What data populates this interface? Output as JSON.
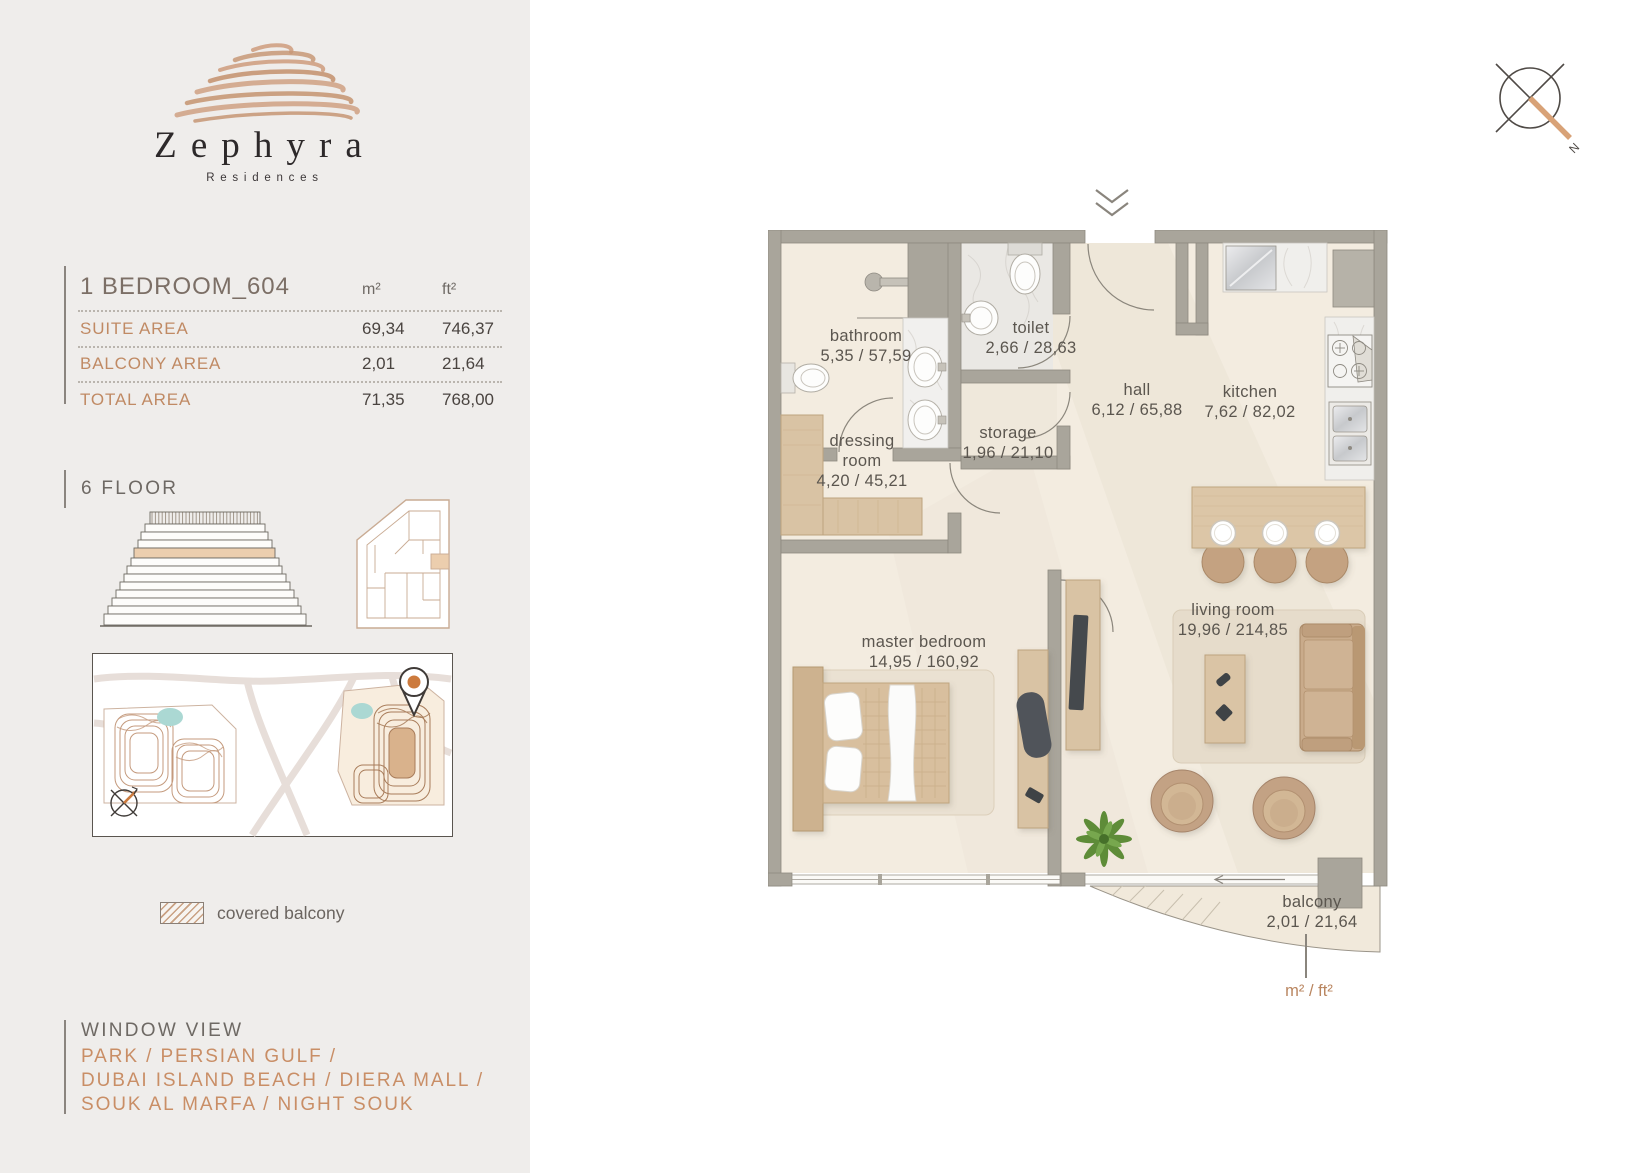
{
  "brand": {
    "name": "Zephyra",
    "tagline": "Residences"
  },
  "unit": {
    "title": "1 BEDROOM_604",
    "col_m2": "m²",
    "col_ft2": "ft²",
    "rows": [
      {
        "label": "SUITE AREA",
        "m2": "69,34",
        "ft2": "746,37"
      },
      {
        "label": "BALCONY AREA",
        "m2": "2,01",
        "ft2": "21,64"
      },
      {
        "label": "TOTAL AREA",
        "m2": "71,35",
        "ft2": "768,00"
      }
    ]
  },
  "floor": {
    "label": "6 FLOOR"
  },
  "legend": {
    "covered_balcony": "covered balcony"
  },
  "window_view": {
    "title": "WINDOW VIEW",
    "lines": [
      "PARK / PERSIAN GULF /",
      "DUBAI ISLAND BEACH / DIERA MALL /",
      "SOUK AL MARFA / NIGHT SOUK"
    ]
  },
  "plan": {
    "rooms": [
      {
        "name": "bathroom",
        "area": "5,35 / 57,59"
      },
      {
        "name": "toilet",
        "area": "2,66 / 28,63"
      },
      {
        "name": "hall",
        "area": "6,12 / 65,88"
      },
      {
        "name": "kitchen",
        "area": "7,62 / 82,02"
      },
      {
        "name": "storage",
        "area": "1,96 / 21,10"
      },
      {
        "name": "dressing room",
        "area": "4,20 / 45,21"
      },
      {
        "name": "master bedroom",
        "area": "14,95 / 160,92"
      },
      {
        "name": "living room",
        "area": "19,96 / 214,85"
      },
      {
        "name": "balcony",
        "area": "2,01 / 21,64"
      }
    ],
    "units_note": "m² / ft²"
  },
  "colors": {
    "accent": "#c98e66",
    "wall": "#a9a59b",
    "floor": "#f3ece0",
    "wood": "#d9c2a3",
    "highlight": "#ecceae",
    "teal": "#abd8d3"
  }
}
